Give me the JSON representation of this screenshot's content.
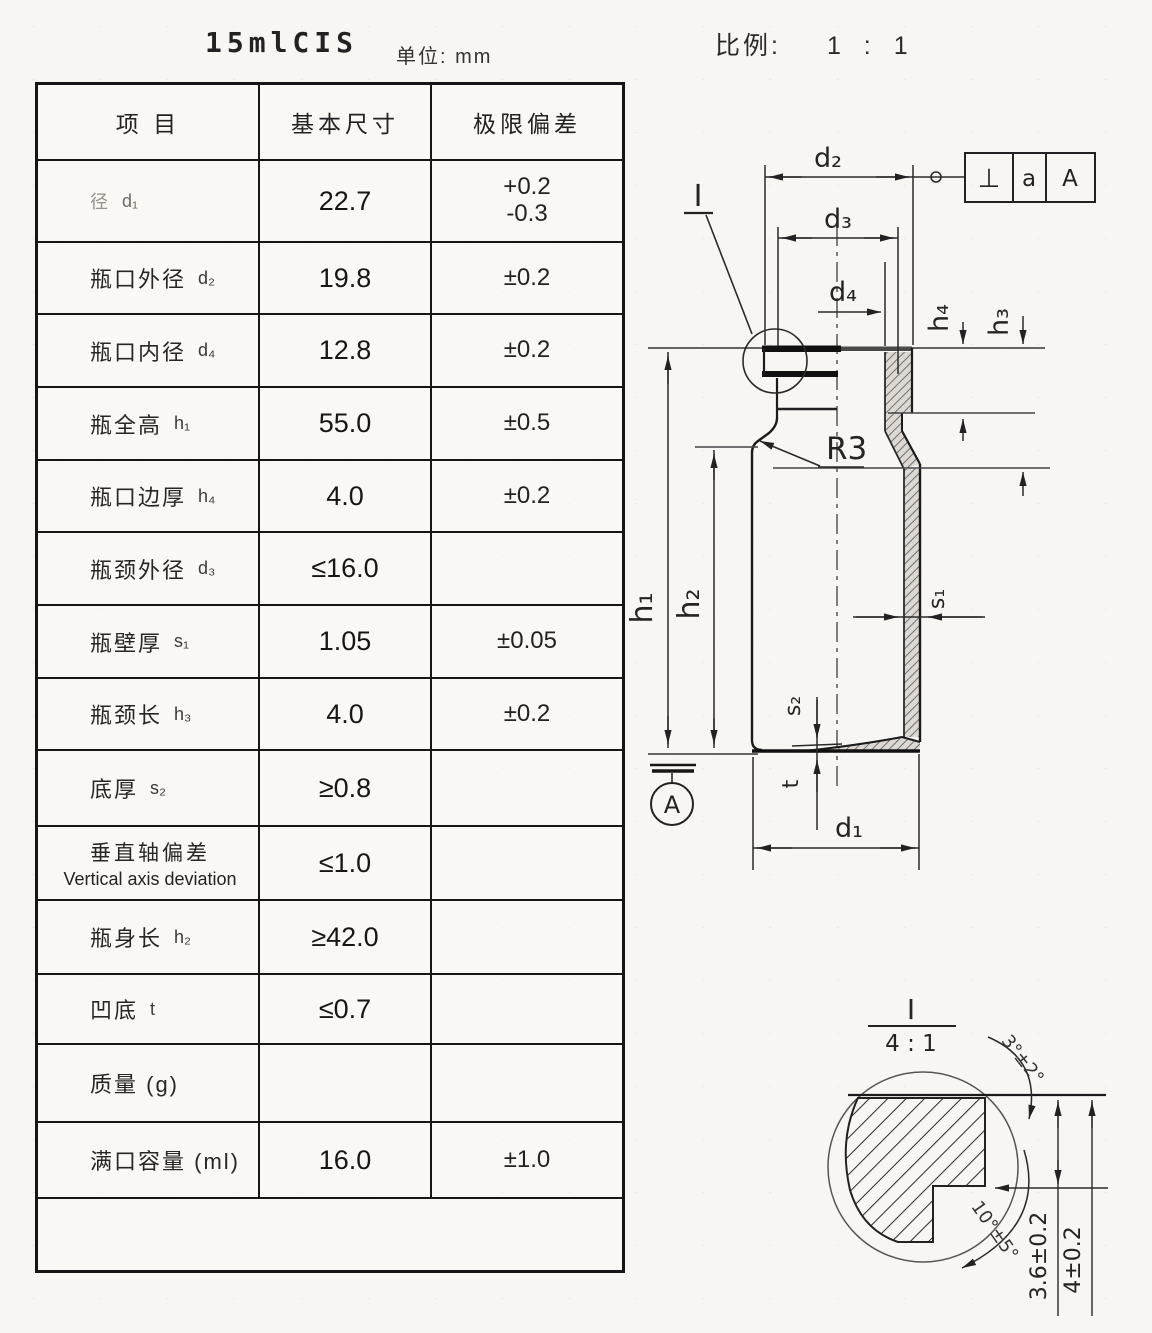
{
  "page": {
    "title": "15mlCIS",
    "unit_label": "单位: mm",
    "scale_label": "比例:",
    "scale_value": "1 : 1"
  },
  "table": {
    "headers": [
      "项  目",
      "基本尺寸",
      "极限偏差"
    ],
    "rows": [
      {
        "item": "径",
        "sym": "d₁",
        "basic": "22.7",
        "tol": "+0.2\n-0.3"
      },
      {
        "item": "瓶口外径",
        "sym": "d₂",
        "basic": "19.8",
        "tol": "±0.2"
      },
      {
        "item": "瓶口内径",
        "sym": "d₄",
        "basic": "12.8",
        "tol": "±0.2"
      },
      {
        "item": "瓶全高",
        "sym": "h₁",
        "basic": "55.0",
        "tol": "±0.5"
      },
      {
        "item": "瓶口边厚",
        "sym": "h₄",
        "basic": "4.0",
        "tol": "±0.2"
      },
      {
        "item": "瓶颈外径",
        "sym": "d₃",
        "basic": "≤16.0",
        "tol": ""
      },
      {
        "item": "瓶壁厚",
        "sym": "s₁",
        "basic": "1.05",
        "tol": "±0.05"
      },
      {
        "item": "瓶颈长",
        "sym": "h₃",
        "basic": "4.0",
        "tol": "±0.2"
      },
      {
        "item": "底厚",
        "sym": "s₂",
        "basic": "≥0.8",
        "tol": ""
      },
      {
        "item": "垂直轴偏差",
        "item_en": "Vertical axis deviation",
        "sym": "",
        "basic": "≤1.0",
        "tol": ""
      },
      {
        "item": "瓶身长",
        "sym": "h₂",
        "basic": "≥42.0",
        "tol": ""
      },
      {
        "item": "凹底",
        "sym": "t",
        "basic": "≤0.7",
        "tol": ""
      },
      {
        "item": "质量 (g)",
        "sym": "",
        "basic": "",
        "tol": ""
      },
      {
        "item": "满口容量 (ml)",
        "sym": "",
        "basic": "16.0",
        "tol": "±1.0"
      }
    ]
  },
  "drawing": {
    "dims": {
      "d2": "d₂",
      "d3": "d₃",
      "d4": "d₄",
      "h4": "h₄",
      "h3": "h₃",
      "h1": "h₁",
      "h2": "h₂",
      "s1": "s₁",
      "s2": "s₂",
      "t": "t",
      "d1": "d₁",
      "r3": "R3"
    },
    "detail_marker": "I",
    "datum_label": "A",
    "fcf": {
      "symbol": "⊥",
      "tolerance": "a",
      "datum": "A"
    },
    "detail": {
      "label": "I",
      "scale": "4 : 1",
      "dim_36": "3.6±0.2",
      "dim_4": "4±0.2",
      "angle_top": "3°±2°",
      "angle_bottom": "10°±5°"
    }
  }
}
